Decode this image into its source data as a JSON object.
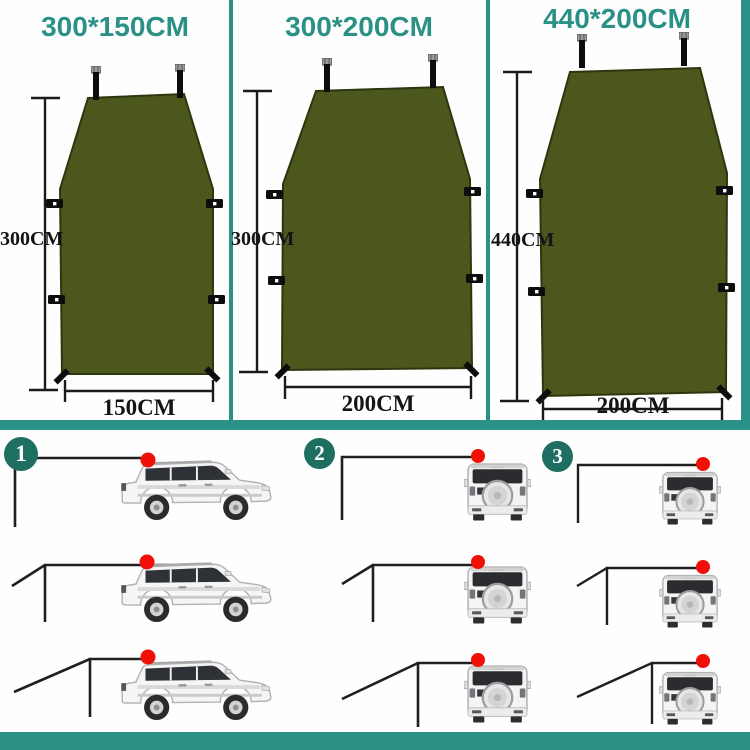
{
  "colors": {
    "accent_teal": "#2b9186",
    "badge_teal": "#1e6e62",
    "tarp_olive": "#4b571d",
    "marker_red": "#f01008",
    "line_black": "#1a1a1a"
  },
  "panels": [
    {
      "title": "300*150CM",
      "height_label": "300CM",
      "width_label": "150CM"
    },
    {
      "title": "300*200CM",
      "height_label": "300CM",
      "width_label": "200CM"
    },
    {
      "title": "440*200CM",
      "height_label": "440CM",
      "width_label": "200CM"
    }
  ],
  "setups": [
    {
      "number": "1",
      "vehicle_view": "suv-side"
    },
    {
      "number": "2",
      "vehicle_view": "suv-rear"
    },
    {
      "number": "3",
      "vehicle_view": "suv-rear"
    }
  ],
  "icons": {
    "tarp-pole-icon": "black support pole with cap on tarp top edge",
    "tie-tab-icon": "black side webbing tab with eyelet",
    "stake-icon": "black ground peg at tarp corner",
    "roof-attachment-dot": "red suction-cup point on car roof",
    "suv-side-image": "white SUV side view",
    "suv-rear-image": "white SUV rear view with spare wheel"
  }
}
